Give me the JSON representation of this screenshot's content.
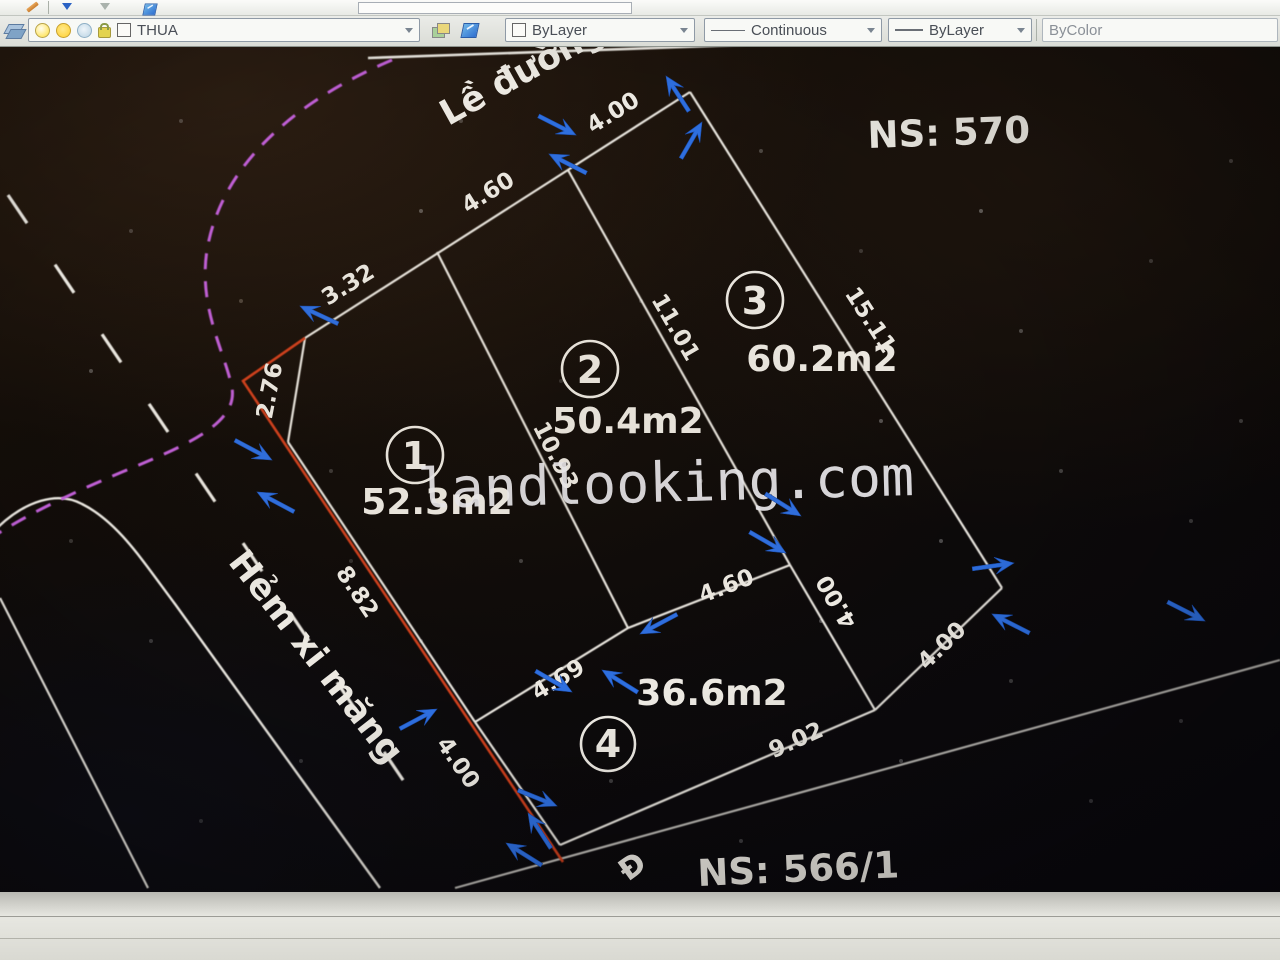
{
  "toolbar": {
    "layer_combo": {
      "value": "THUA"
    },
    "color_combo": {
      "value": "ByLayer"
    },
    "linetype_combo": {
      "value": "Continuous"
    },
    "lineweight_combo": {
      "value": "ByLayer"
    },
    "plotstyle_combo": {
      "value": "ByColor"
    }
  },
  "drawing": {
    "watermark": "landlooking.com",
    "labels": {
      "road_top": "Lề đường",
      "alley_left": "Hẻm xi măng",
      "ns_top": "NS: 570",
      "ns_bottom": "NS: 566/1",
      "street_partial": "Đ"
    },
    "parcels": [
      {
        "no": "1",
        "area": "52.3m2"
      },
      {
        "no": "2",
        "area": "50.4m2"
      },
      {
        "no": "3",
        "area": "60.2m2"
      },
      {
        "no": "4",
        "area": "36.6m2"
      }
    ],
    "dimensions": {
      "top_seg1": "3.32",
      "top_seg2": "4.60",
      "top_seg3": "4.00",
      "bevel": "2.76",
      "west": "8.82",
      "p1_p2": "10.93",
      "p2_p3": "11.01",
      "east": "15.11",
      "p4_west": "4.00",
      "p4_top1": "4.69",
      "p4_top2": "4.60",
      "p3_p4": "4.00",
      "p3_se": "4.00",
      "p4_south": "9.02"
    },
    "colors": {
      "grip_blue": "#2e6fe0",
      "selected_red": "#d0401c",
      "easement_magenta": "#c05fd6",
      "line_white": "#eae7e0"
    }
  }
}
